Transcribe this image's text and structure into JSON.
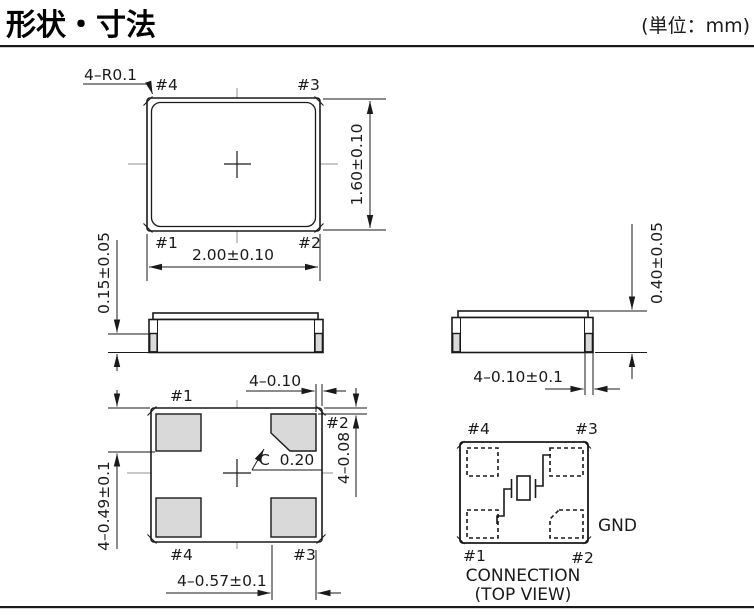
{
  "header": {
    "title": "形状・寸法",
    "unit_note": "(単位：mm)"
  },
  "top_view": {
    "pin4": "#4",
    "pin3": "#3",
    "pin1": "#1",
    "pin2": "#2",
    "dim_corner_radius": "4–R0.1",
    "dim_width": "2.00±0.10",
    "dim_height": "1.60±0.10"
  },
  "side_left": {
    "dim_terminal_height": "0.15±0.05"
  },
  "side_right": {
    "dim_body_height": "0.40±0.05",
    "dim_terminal_width": "4–0.10±0.1"
  },
  "bottom_view": {
    "pin1": "#1",
    "pin2": "#2",
    "pin3": "#3",
    "pin4": "#4",
    "dim_pad_edge_gap_x": "4–0.10",
    "dim_pad_edge_gap_y": "4–0.08",
    "dim_pad_height": "4–0.49±0.1",
    "dim_pad_width": "4–0.57±0.1",
    "dim_chamfer": "C  0.20"
  },
  "connection": {
    "pin4": "#4",
    "pin3": "#3",
    "pin1": "#1",
    "pin2": "#2",
    "gnd": "GND",
    "caption1": "CONNECTION",
    "caption2": "(TOP VIEW)"
  },
  "colors": {
    "line": "#1a1a1a",
    "pad_fill": "#d9d9d9",
    "centerline": "#909090",
    "background": "#ffffff"
  }
}
